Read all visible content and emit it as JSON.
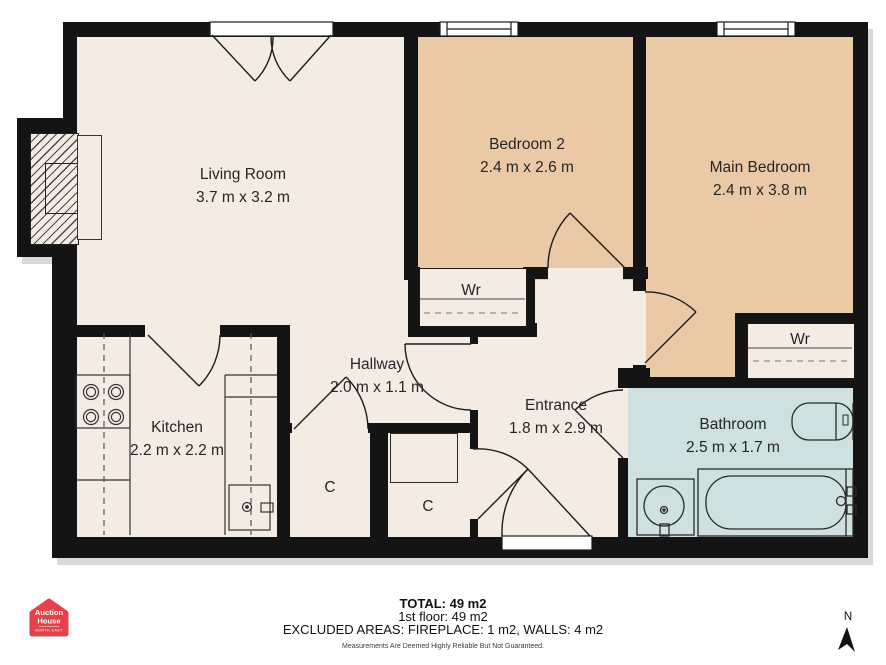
{
  "plan": {
    "rooms": [
      {
        "name": "Living Room",
        "dims": "3.7 m x 3.2 m"
      },
      {
        "name": "Bedroom 2",
        "dims": "2.4 m x 2.6 m"
      },
      {
        "name": "Main Bedroom",
        "dims": "2.4 m x 3.8 m"
      },
      {
        "name": "Kitchen",
        "dims": "2.2 m x 2.2 m"
      },
      {
        "name": "Hallway",
        "dims": "2.0 m x 1.1 m"
      },
      {
        "name": "Entrance",
        "dims": "1.8 m x 2.9 m"
      },
      {
        "name": "Bathroom",
        "dims": "2.5 m x 1.7 m"
      }
    ],
    "closets": [
      {
        "label": "Wr"
      },
      {
        "label": "Wr"
      },
      {
        "label": "C"
      },
      {
        "label": "C"
      }
    ]
  },
  "footer": {
    "total": "TOTAL: 49 m2",
    "floor": "1st floor: 49 m2",
    "excluded": "EXCLUDED AREAS: FIREPLACE: 1 m2, WALLS: 4 m2",
    "disclaimer": "Measurements Are Deemed Highly Reliable But Not Guaranteed."
  },
  "logo": {
    "line1": "Auction",
    "line2": "House",
    "region": "NORTH EAST"
  },
  "compass": {
    "north": "N"
  },
  "colors": {
    "wall": "#141414",
    "floor_cream": "#f4ece3",
    "bedroom_tan": "#ecc9a6",
    "bathroom_blue": "#cfe0e0",
    "logo_red": "#e2434b"
  }
}
